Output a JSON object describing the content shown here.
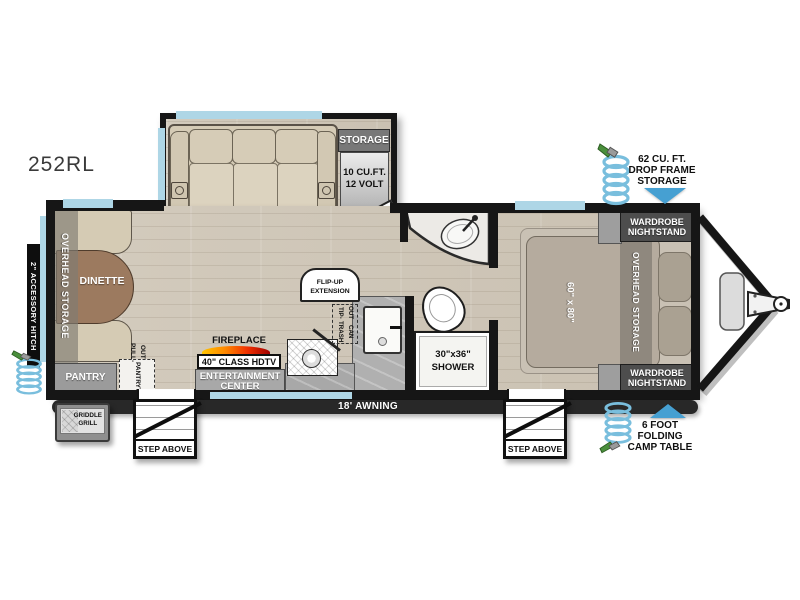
{
  "model": "252RL",
  "colors": {
    "wall": "#161616",
    "window_glass": "#aed6e6",
    "arrow_accent": "#46a0d2",
    "floor_wood": "#cfc7b9",
    "furniture_beige": "#d6ccb7",
    "cabinet_gray": "#9e9e9e",
    "label_dark": "#4d4d4d",
    "fireplace_flame": "#f03000",
    "hose_blue": "#79bedd",
    "nozzle_green": "#4a8f3c"
  },
  "exterior": {
    "accessory_hitch": "2\" ACCESSORY HITCH",
    "awning": "18' AWNING",
    "step_left": "STEP ABOVE",
    "step_right": "STEP ABOVE",
    "griddle": {
      "line1": "GRIDDLE",
      "line2": "GRILL"
    },
    "drop_frame_storage": {
      "line1": "62 CU. FT.",
      "line2": "DROP FRAME",
      "line3": "STORAGE"
    },
    "camp_table": {
      "line1": "6 FOOT",
      "line2": "FOLDING",
      "line3": "CAMP TABLE"
    }
  },
  "living": {
    "dinette": "DINETTE",
    "overhead_storage": "OVERHEAD STORAGE",
    "pantry": "PANTRY",
    "pantry_trays": {
      "line1": "PULL-OUT",
      "line2": "PANTRY",
      "line3": "TRAYS"
    },
    "storage": "STORAGE",
    "fridge": {
      "line1": "10 CU.FT.",
      "line2": "12 VOLT"
    },
    "fireplace": "FIREPLACE",
    "hdtv": "40\" CLASS HDTV",
    "entertainment": {
      "line1": "ENTERTAINMENT",
      "line2": "CENTER"
    }
  },
  "kitchen": {
    "flip_up": {
      "line1": "FLIP-UP",
      "line2": "EXTENSION"
    },
    "trash": {
      "line1": "TIP-OUT",
      "line2": "TRASH CAN"
    }
  },
  "bath": {
    "shower": {
      "line1": "30\"x36\"",
      "line2": "SHOWER"
    }
  },
  "bedroom": {
    "bed_size": "60\" x 80\"",
    "overhead_storage": "OVERHEAD STORAGE",
    "wardrobe_top": {
      "line1": "WARDROBE",
      "line2": "NIGHTSTAND"
    },
    "wardrobe_bottom": {
      "line1": "WARDROBE",
      "line2": "NIGHTSTAND"
    }
  }
}
